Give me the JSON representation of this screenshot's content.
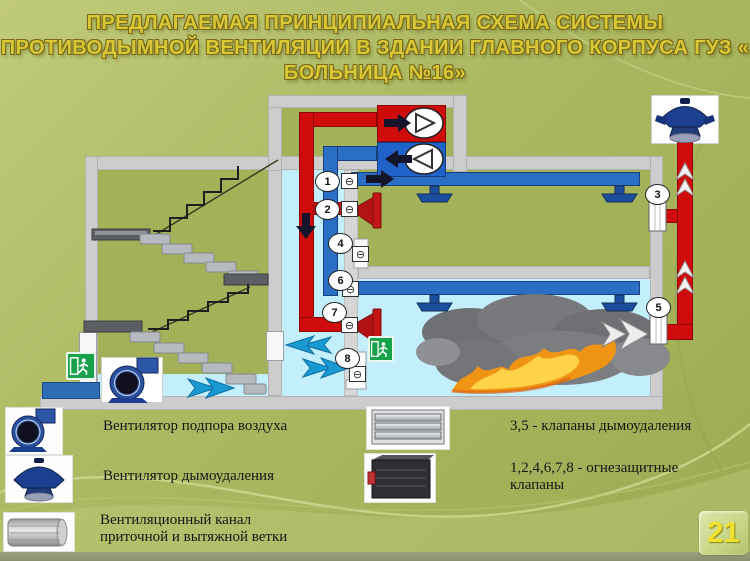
{
  "slide": {
    "title_lines": [
      "ПРЕДЛАГАЕМАЯ ПРИНЦИПИАЛЬНАЯ СХЕМА СИСТЕМЫ",
      "ПРОТИВОДЫМНОЙ ВЕНТИЛЯЦИИ В ЗДАНИИ ГЛАВНОГО КОРПУСА  ГУЗ «",
      "БОЛЬНИЦА №16»"
    ],
    "page_number": "21"
  },
  "diagram": {
    "valves": {
      "v1": "1",
      "v2": "2",
      "v3": "3",
      "v4": "4",
      "v5": "5",
      "v6": "6",
      "v7": "7",
      "v8": "8"
    },
    "damper_symbol": "⊖",
    "icons": {
      "supply_fan": "centrifugal-fan",
      "exhaust_fan": "roof-fan",
      "exit": "exit-sign-running-man",
      "fire": "fire-and-smoke"
    }
  },
  "legend": {
    "left": [
      {
        "icon": "centrifugal-fan-icon",
        "label": "Вентилятор подпора воздуха"
      },
      {
        "icon": "roof-fan-icon",
        "label": "Вентилятор дымоудаления"
      },
      {
        "icon": "duct-channel-icon",
        "label": "Вентиляционный канал",
        "label2": "приточной и вытяжной ветки"
      }
    ],
    "right": [
      {
        "icon": "smoke-damper-icon",
        "label": "3,5 - клапаны дымоудаления"
      },
      {
        "icon": "fire-damper-icon",
        "label": "1,2,4,6,7,8 - огнезащитные",
        "label2": "клапаны"
      }
    ]
  },
  "colors": {
    "supply_duct_red": "#cf0b0b",
    "exhaust_duct_blue": "#2a6fc4",
    "flow_arrow_blue": "#1a9ad2",
    "exit_green": "#17a24b",
    "title_gold": "#d8c836",
    "room_cyan": "#c3eefb",
    "wall_gray": "#cdcdcd"
  }
}
